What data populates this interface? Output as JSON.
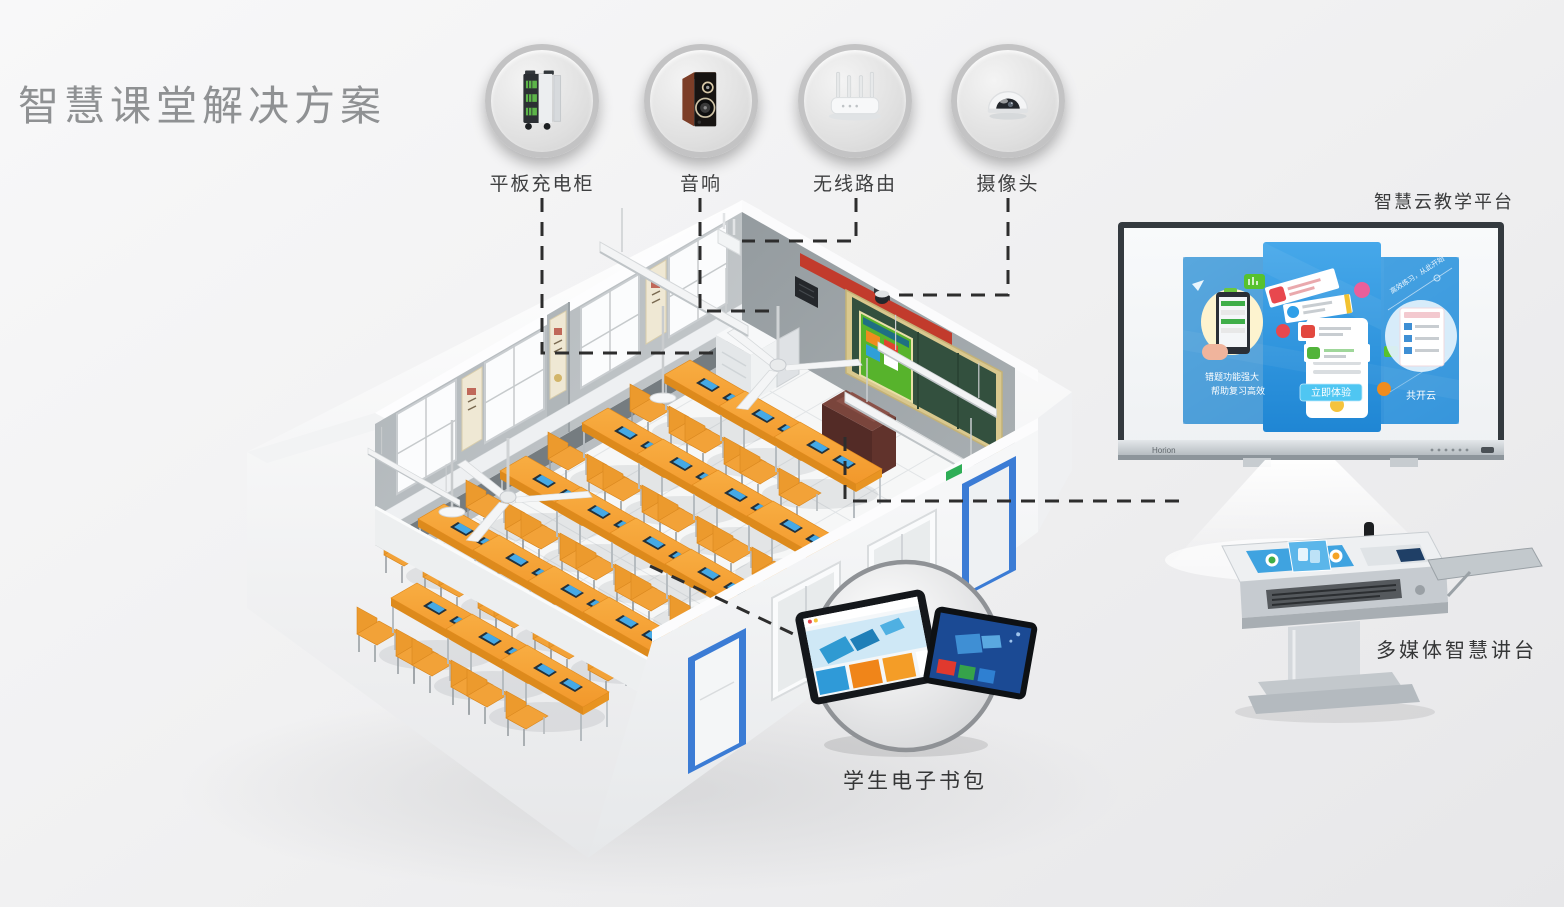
{
  "title": "智慧课堂解决方案",
  "devices": [
    {
      "label": "平板充电柜"
    },
    {
      "label": "音响"
    },
    {
      "label": "无线路由"
    },
    {
      "label": "摄像头"
    }
  ],
  "platform": {
    "label": "智慧云教学平台",
    "brand": "Horion",
    "screen": {
      "left_line1": "错题功能强大",
      "left_line2": "帮助复习高效",
      "cta": "立即体验",
      "cloud": "共开云",
      "slogan": "高效练习，从此开始"
    }
  },
  "podium": {
    "label": "多媒体智慧讲台"
  },
  "ebag": {
    "label": "学生电子书包"
  }
}
